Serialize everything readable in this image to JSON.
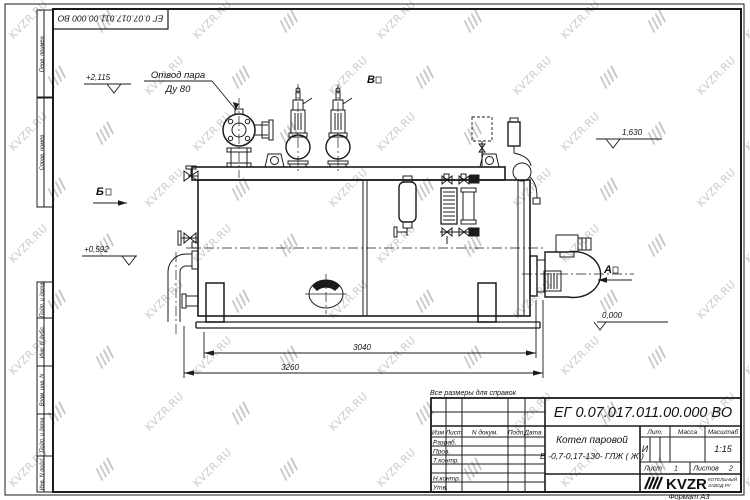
{
  "watermark": {
    "text": "KVZR.RU"
  },
  "frame": {
    "format_label": "Формат А3",
    "top_stamp": "ЕГ 0.07.017.011.00.000  ВО",
    "margin_top": [
      "Перв. примен.",
      "Справ. номер"
    ],
    "margin_bottom": [
      "Подп. и дата",
      "Инв. N дубл.",
      "Взам. инв. N",
      "Подп. и дата",
      "Инв. N подл."
    ]
  },
  "annotations": {
    "steam_line1": "Отвод пара",
    "steam_line2": "Ду 80",
    "lvl_2115": "+2,115",
    "lvl_1630": "1,630",
    "lvl_0592": "+0,592",
    "lvl_0000": "0,000",
    "view_a": "А",
    "view_b": "Б",
    "view_v": "В",
    "dim_3040": "3040",
    "dim_3260": "3260",
    "note": "Все размеры для справок"
  },
  "title_block": {
    "doc_number": "ЕГ 0.07.017.011.00.000  ВО",
    "product_line1": "Котел паровой",
    "product_line2": "Е -0,7-0,17-130- ГЛЖ ( Ж )",
    "col_izm": "Изм",
    "col_list": "Лист",
    "col_doc": "N докум.",
    "col_sign": "Подп.",
    "col_date": "Дата",
    "row_razrab": "Разраб.",
    "row_prov": "Пров.",
    "row_tkontr": "Т.контр.",
    "row_nkontr": "Н.контр.",
    "row_utv": "Утв.",
    "lit_label": "Лит.",
    "mass_label": "Масса",
    "scale_label": "Масштаб",
    "lit_value": "И",
    "scale_value": "1:15",
    "sheet_label": "Лист",
    "sheet_value": "1",
    "sheets_label": "Листов",
    "sheets_value": "2",
    "brand": "KVZR",
    "brand_sub1": "КОТЕЛЬНЫЙ",
    "brand_sub2": "ЗАВОД.РУ"
  }
}
